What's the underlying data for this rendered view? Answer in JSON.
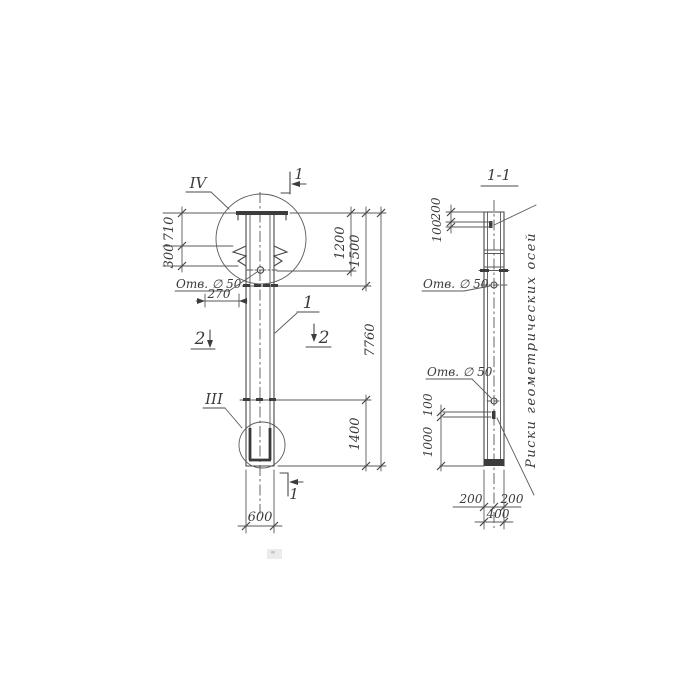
{
  "drawing": {
    "background": "#ffffff",
    "line_color": "#474747",
    "main_view": {
      "detail_labels": {
        "top": "IV",
        "bottom": "III"
      },
      "section_marks": {
        "one_top": "1",
        "one_bottom": "1",
        "two_left": "2",
        "two_right": "2"
      },
      "part_label": "1",
      "hole_label": "Отв. ∅ 50",
      "dims": {
        "d710": "710",
        "d300": "300",
        "d270": "270",
        "d1200": "1200",
        "d1500": "1500",
        "d7760": "7760",
        "d1400": "1400",
        "d600": "600"
      }
    },
    "section_view": {
      "title": "1-1",
      "hole_label_upper": "Отв. ∅ 50",
      "hole_label_lower": "Отв. ∅ 50",
      "axes_note": "Риски геометрических осей",
      "dims": {
        "d200_top": "200",
        "d100_top": "100",
        "d100_mid": "100",
        "d1000": "1000",
        "d200_left": "200",
        "d200_right": "200",
        "d400": "400"
      }
    }
  }
}
